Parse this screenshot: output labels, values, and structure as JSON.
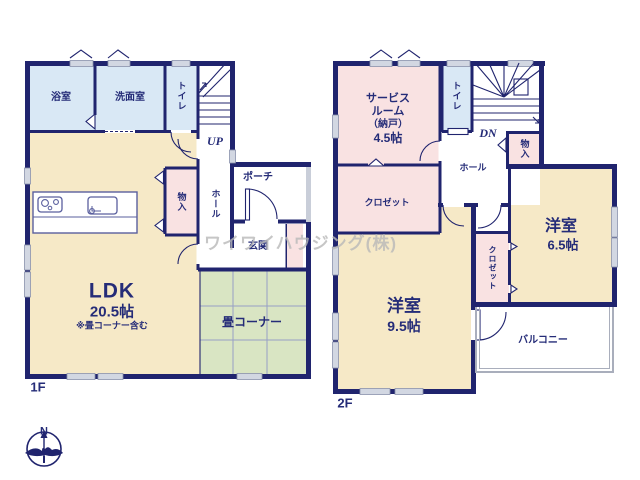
{
  "watermark": {
    "text": "ワイワイハウジング(株)"
  },
  "compass": {
    "north_label": "N"
  },
  "floor1": {
    "floor_label": "1F",
    "stairs_label": "UP",
    "rooms": {
      "bath": "浴室",
      "washroom": "洗面室",
      "toilet": "トイレ",
      "storage": "物入",
      "hall": "ホール",
      "porch": "ポーチ",
      "entry": "玄関",
      "ldk_name": "LDK",
      "ldk_size": "20.5帖",
      "ldk_note": "※畳コーナー含む",
      "tatami_corner": "畳コーナー"
    }
  },
  "floor2": {
    "floor_label": "2F",
    "stairs_label": "DN",
    "rooms": {
      "service_room_line1": "サービス",
      "service_room_line2": "ルーム",
      "service_room_line3": "（納戸）",
      "service_room_size": "4.5帖",
      "toilet": "トイレ",
      "storage": "物入",
      "hall": "ホール",
      "closet_west": "クロゼット",
      "closet_center": "クロゼット",
      "bedroom_east_name": "洋室",
      "bedroom_east_size": "6.5帖",
      "bedroom_south_name": "洋室",
      "bedroom_south_size": "9.5帖",
      "balcony": "バルコニー"
    }
  },
  "colors": {
    "wall": "#20246e",
    "water_room": "#d9e8f5",
    "living": "#f6e9c7",
    "closet": "#f9e2e2",
    "tatami": "#d9e5c3",
    "text": "#252c78",
    "watermark": "#b9b9b9"
  }
}
